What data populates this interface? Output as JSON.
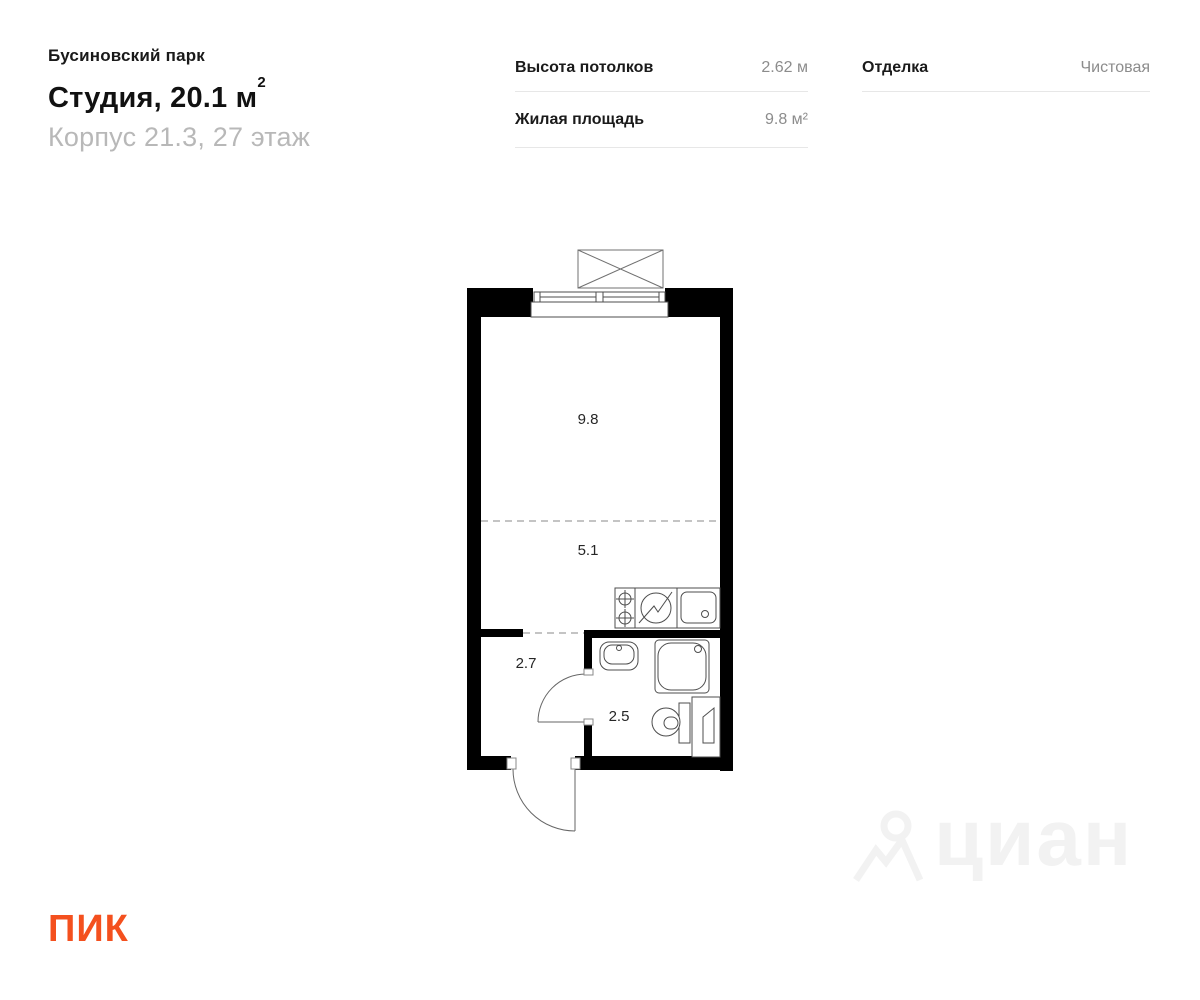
{
  "header": {
    "project": "Бусиновский парк",
    "title": "Студия, 20.1 м",
    "title_sup": "2",
    "subtitle": "Корпус 21.3, 27 этаж",
    "specs": [
      {
        "label": "Высота потолков",
        "value": "2.62 м"
      },
      {
        "label": "Жилая площадь",
        "value": "9.8 м²"
      }
    ],
    "finish_label": "Отделка",
    "finish_value": "Чистовая"
  },
  "plan": {
    "rooms": [
      {
        "name": "living-area",
        "area": "9.8"
      },
      {
        "name": "kitchen-area",
        "area": "5.1"
      },
      {
        "name": "hallway",
        "area": "2.7"
      },
      {
        "name": "bathroom",
        "area": "2.5"
      }
    ]
  },
  "watermark": {
    "text": "циан"
  },
  "footer": {
    "logo_text": "ПИК"
  },
  "colors": {
    "accent": "#f4501e",
    "wall": "#000000",
    "thin_line": "#4d4d4d",
    "value_gray": "#8c8c8c",
    "subtitle_gray": "#b8b8b8",
    "divider": "#e7e7e7",
    "watermark": "#f2f2f2"
  }
}
